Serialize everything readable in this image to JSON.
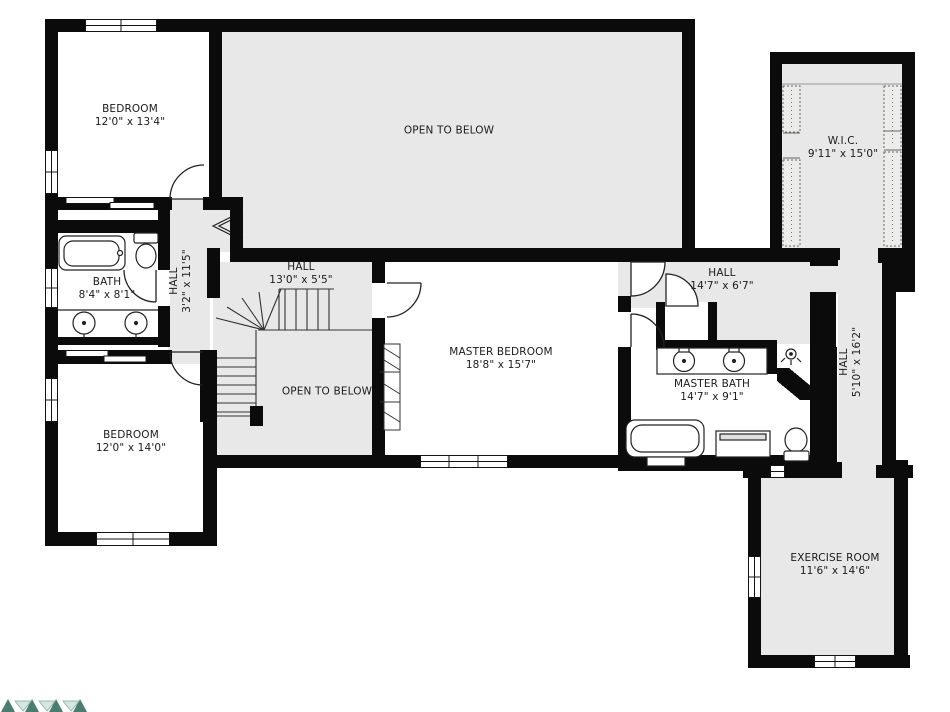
{
  "plan": {
    "rooms": [
      {
        "id": "bedroom-1",
        "label": "BEDROOM",
        "dims": "12'0\" x 13'4\""
      },
      {
        "id": "open-to-below-top",
        "label": "OPEN TO BELOW",
        "dims": ""
      },
      {
        "id": "walk-in-closet",
        "label": "W.I.C.",
        "dims": "9'11\" x 15'0\""
      },
      {
        "id": "bath",
        "label": "BATH",
        "dims": "8'4\" x 8'1\""
      },
      {
        "id": "hall-upper-left",
        "label": "HALL",
        "dims": "3'2\" x 11'5\""
      },
      {
        "id": "hall-center",
        "label": "HALL",
        "dims": "13'0\" x 5'5\""
      },
      {
        "id": "open-to-below-center",
        "label": "OPEN TO BELOW",
        "dims": ""
      },
      {
        "id": "master-bedroom",
        "label": "MASTER BEDROOM",
        "dims": "18'8\" x 15'7\""
      },
      {
        "id": "hall-right",
        "label": "HALL",
        "dims": "14'7\" x 6'7\""
      },
      {
        "id": "master-bath",
        "label": "MASTER BATH",
        "dims": "14'7\" x 9'1\""
      },
      {
        "id": "hall-right-vertical",
        "label": "HALL",
        "dims": "5'10\" x 16'2\""
      },
      {
        "id": "bedroom-2",
        "label": "BEDROOM",
        "dims": "12'0\" x 14'0\""
      },
      {
        "id": "exercise-room",
        "label": "EXERCISE ROOM",
        "dims": "11'6\" x 14'6\""
      }
    ],
    "fixtures": [
      {
        "name": "bathtub-icon",
        "room": "bath"
      },
      {
        "name": "toilet-icon",
        "room": "bath"
      },
      {
        "name": "sink-icon",
        "room": "bath",
        "count": 2
      },
      {
        "name": "bathtub-icon",
        "room": "master-bath"
      },
      {
        "name": "toilet-icon",
        "room": "master-bath"
      },
      {
        "name": "sink-icon",
        "room": "master-bath",
        "count": 2
      },
      {
        "name": "shower-head-icon",
        "room": "master-bath"
      },
      {
        "name": "staircase",
        "room": "hall-center"
      },
      {
        "name": "closet-shelves",
        "room": "walk-in-closet",
        "count": 2
      }
    ],
    "colors": {
      "wall": "#0b0b0b",
      "floor_shaded": "#e8e8e8",
      "floor_room": "#ffffff",
      "line": "#222222",
      "watermark_dark": "#4a7d70",
      "watermark_light": "#93b7ac"
    }
  }
}
